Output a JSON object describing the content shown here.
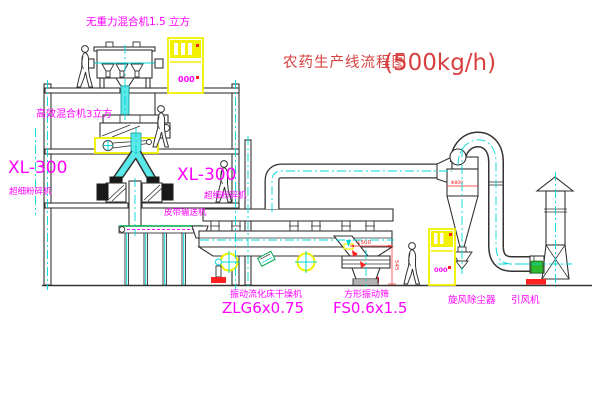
{
  "title": {
    "name": "农药生产线流程图",
    "capacity": "(500kg/h)"
  },
  "equipment_labels": {
    "gravity_mixer": "无重力混合机1.5 立方",
    "high_mixer": "高效混合机3立方",
    "mill_left_model": "XL-300",
    "mill_left_name": "超细粉碎机",
    "mill_mid_model": "XL-300",
    "mill_mid_name": "超细粉碎机",
    "belt_conveyor": "皮带输送机",
    "dryer_name": "振动流化床干燥机",
    "dryer_model": "ZLG6x0.75",
    "screen_name": "方形振动筛",
    "screen_model": "FS0.6x1.5",
    "cyclone_name": "旋风除尘器",
    "fan_name": "引风机"
  },
  "dimensions": {
    "screen_length": "1500",
    "screen_height": "545",
    "cyclone_note": "Φ800"
  },
  "panels": {
    "top_cabinet_display": "000",
    "right_cabinet_display": "000"
  },
  "colors": {
    "line": "#333333",
    "centerline": "#00d8d8",
    "label": "#ff00ff",
    "title": "#d84040",
    "highlight": "#ffff00",
    "dimension": "#ff2020",
    "conveyor_belt": "#00a550"
  }
}
